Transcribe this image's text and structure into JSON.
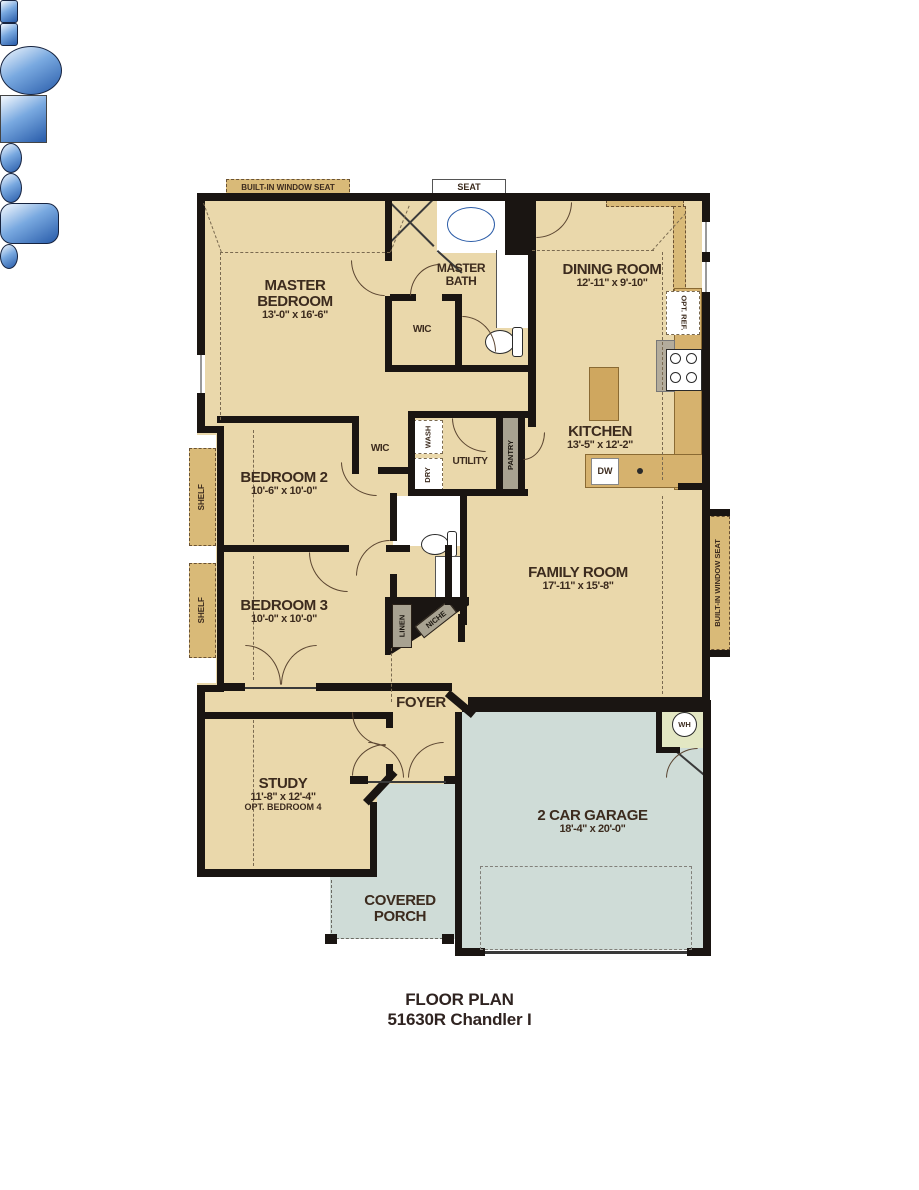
{
  "plan": {
    "title_line1": "FLOOR PLAN",
    "title_line2": "51630R Chandler I"
  },
  "rooms": {
    "master_bedroom": {
      "name": "MASTER BEDROOM",
      "dims": "13'-0\" x 16'-6\""
    },
    "master_bath": {
      "name": "MASTER BATH"
    },
    "master_wic": {
      "name": "WIC"
    },
    "dining_room": {
      "name": "DINING ROOM",
      "dims": "12'-11\" x 9'-10\""
    },
    "kitchen": {
      "name": "KITCHEN",
      "dims": "13'-5\" x 12'-2\""
    },
    "bedroom_2": {
      "name": "BEDROOM 2",
      "dims": "10'-6\" x 10'-0\""
    },
    "bedroom_3": {
      "name": "BEDROOM 3",
      "dims": "10'-0\" x 10'-0\""
    },
    "utility": {
      "name": "UTILITY"
    },
    "wic_2": {
      "name": "WIC"
    },
    "family_room": {
      "name": "FAMILY ROOM",
      "dims": "17'-11\" x 15'-8\""
    },
    "foyer": {
      "name": "FOYER"
    },
    "study": {
      "name": "STUDY",
      "dims": "11'-8\" x 12'-4\"",
      "note": "OPT. BEDROOM 4"
    },
    "garage": {
      "name": "2 CAR GARAGE",
      "dims": "18'-4\" x 20'-0\""
    },
    "covered_porch": {
      "name": "COVERED PORCH"
    }
  },
  "fixtures": {
    "built_in_window_seat_top": "BUILT-IN WINDOW SEAT",
    "built_in_window_seat_right": "BUILT-IN WINDOW SEAT",
    "seat": "SEAT",
    "opt_ref": "OPT. REF.",
    "dw": "DW",
    "wash": "WASH",
    "dry": "DRY",
    "pantry": "PANTRY",
    "shelf": "SHELF",
    "linen": "LINEN",
    "niche": "NICHE",
    "wh": "WH"
  },
  "colors": {
    "floor_tan": "#ead8ab",
    "garage_porch": "#cfdcd7",
    "wall_black": "#1a1512",
    "cabinet_tan": "#d6b26e",
    "window_seat_tan": "#d9ba78",
    "fixture_blue": "#3c78c8",
    "wh_closet_green": "#e3e7c3"
  }
}
